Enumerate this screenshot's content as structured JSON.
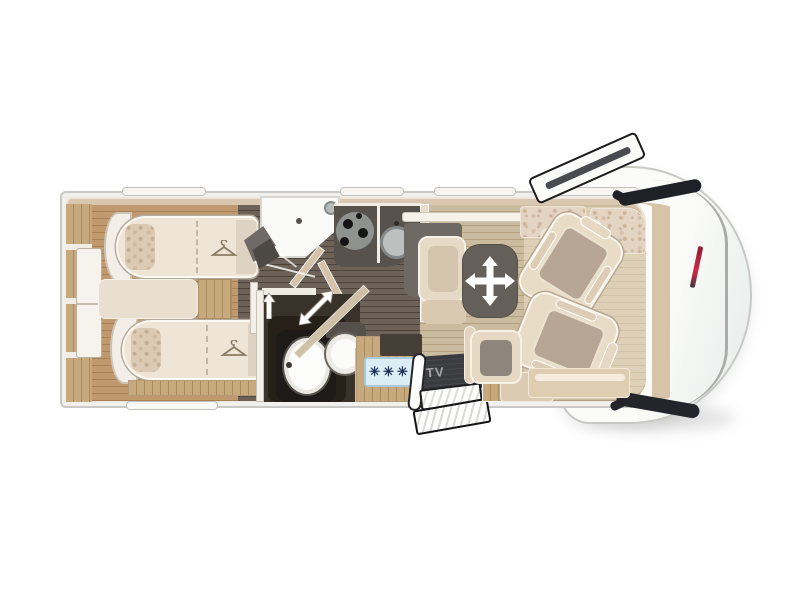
{
  "labels": {
    "tv": "TV",
    "freezer_stars": "✳✳✳"
  },
  "colors": {
    "background": "#ffffff",
    "body_outline": "#c9c8c5",
    "wall_band": "#d9c7b0",
    "floor_bedroom_wood": "#c09a6e",
    "floor_corridor_wood": "#655a4f",
    "floor_lounge_wood": "#c7b697",
    "upholstery_beige": "#e9dcc7",
    "seat_cushion_gray": "#b7a695",
    "table_gray": "#646059",
    "kitchen_counter": "#57524c",
    "freezer_panel_blue": "#dbeef6",
    "freezer_stars_navy": "#1f3358",
    "tv_panel": "#3b3c40",
    "tv_text": "#a6a6a8",
    "brand_decal_red": "#c01f36",
    "mirror_black": "#202126",
    "arrow_white": "#ffffff"
  }
}
